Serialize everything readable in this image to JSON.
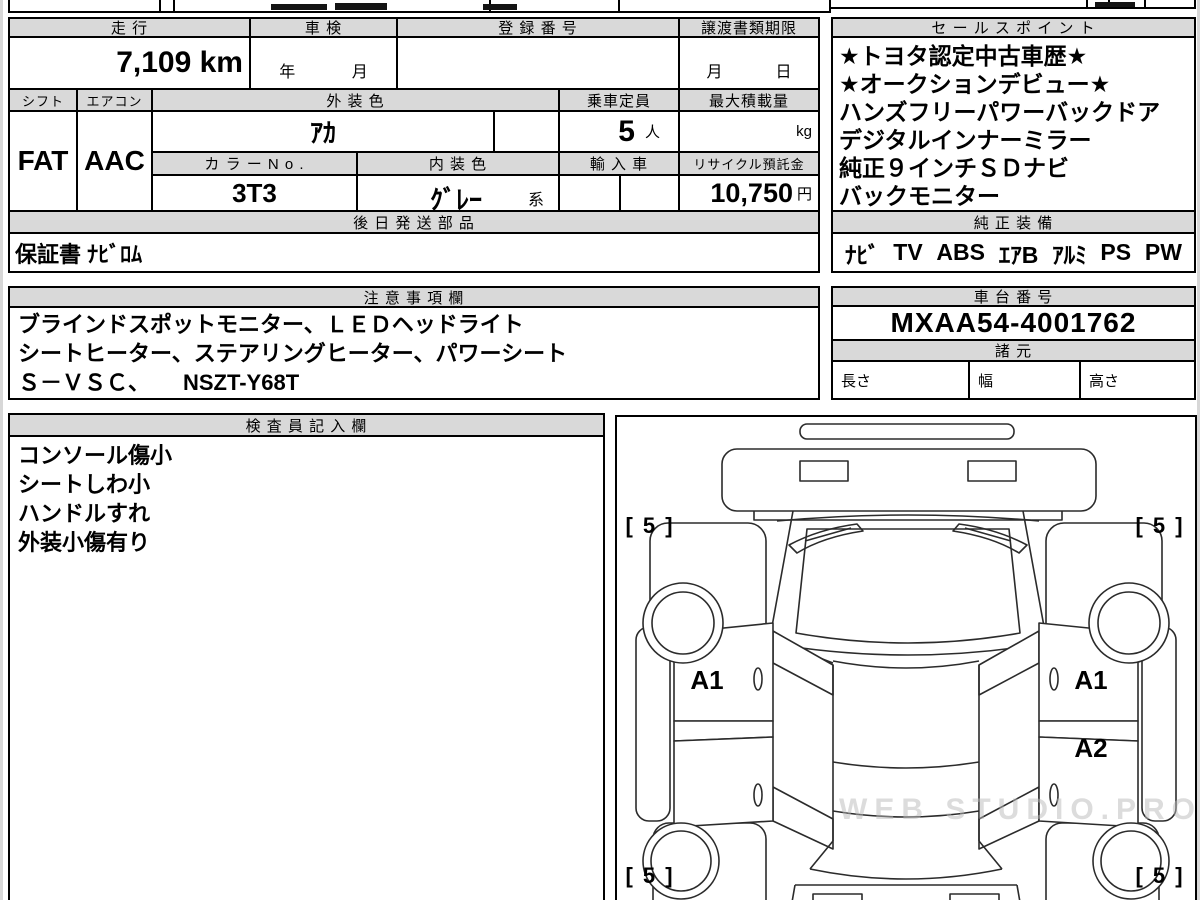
{
  "page": {
    "watermark": "WEB STUDIO.PRO"
  },
  "top_table": {
    "mileage_label": "走 行",
    "mileage_value": "7,109 km",
    "shaken_label": "車 検",
    "shaken_year": "年",
    "shaken_month": "月",
    "registration_label": "登 録 番 号",
    "registration_value": "",
    "transfer_label": "譲渡書類期限",
    "transfer_month": "月",
    "transfer_day": "日",
    "shift_label": "シフト",
    "shift_value": "FAT",
    "aircon_label": "エアコン",
    "aircon_value": "AAC",
    "exterior_color_label": "外 装 色",
    "exterior_color_value": "ｱｶ",
    "color_no_label": "カ ラ ー N o .",
    "color_no_value": "3T3",
    "interior_color_label": "内 装 色",
    "interior_color_value": "ｸﾞﾚｰ",
    "interior_color_suffix": "系",
    "capacity_label": "乗車定員",
    "capacity_value": "5",
    "capacity_unit": "人",
    "max_load_label": "最大積載量",
    "max_load_unit": "kg",
    "import_label": "輸 入 車",
    "recycle_label": "リサイクル預託金",
    "recycle_value": "10,750",
    "recycle_unit": "円",
    "later_parts_label": "後 日 発 送 部 品",
    "later_parts_value": "保証書 ﾅﾋﾞﾛﾑ"
  },
  "sales": {
    "label": "セ ー ル ス ポ イ ン ト",
    "lines": [
      "★トヨタ認定中古車歴★",
      "★オークションデビュー★",
      "ハンズフリーパワーバックドア",
      "デジタルインナーミラー",
      "純正９インチＳＤナビ",
      "バックモニター"
    ]
  },
  "equipment": {
    "label": "純 正 装 備",
    "items": [
      "ﾅﾋﾞ",
      "TV",
      "ABS",
      "ｴｱB",
      "ｱﾙﾐ",
      "PS",
      "PW"
    ]
  },
  "notes": {
    "label": "注 意 事 項 欄",
    "lines": [
      "ブラインドスポットモニター、ＬＥＤヘッドライト",
      "シートヒーター、ステアリングヒーター、パワーシート",
      "Ｓ－ＶＳＣ、　　NSZT-Y68T"
    ]
  },
  "chassis": {
    "label": "車 台 番 号",
    "value": "MXAA54-4001762"
  },
  "specs": {
    "label": "諸 元",
    "dims": [
      "長さ",
      "幅",
      "高さ"
    ]
  },
  "inspector": {
    "label": "検 査 員 記 入 欄",
    "lines": [
      "コンソール傷小",
      "シートしわ小",
      "ハンドルすれ",
      "外装小傷有り"
    ]
  },
  "diagram": {
    "tires": [
      "[ 5 ]",
      "[ 5 ]",
      "[ 5 ]",
      "[ 5 ]"
    ],
    "marks": [
      "A1",
      "A1",
      "A2"
    ]
  }
}
